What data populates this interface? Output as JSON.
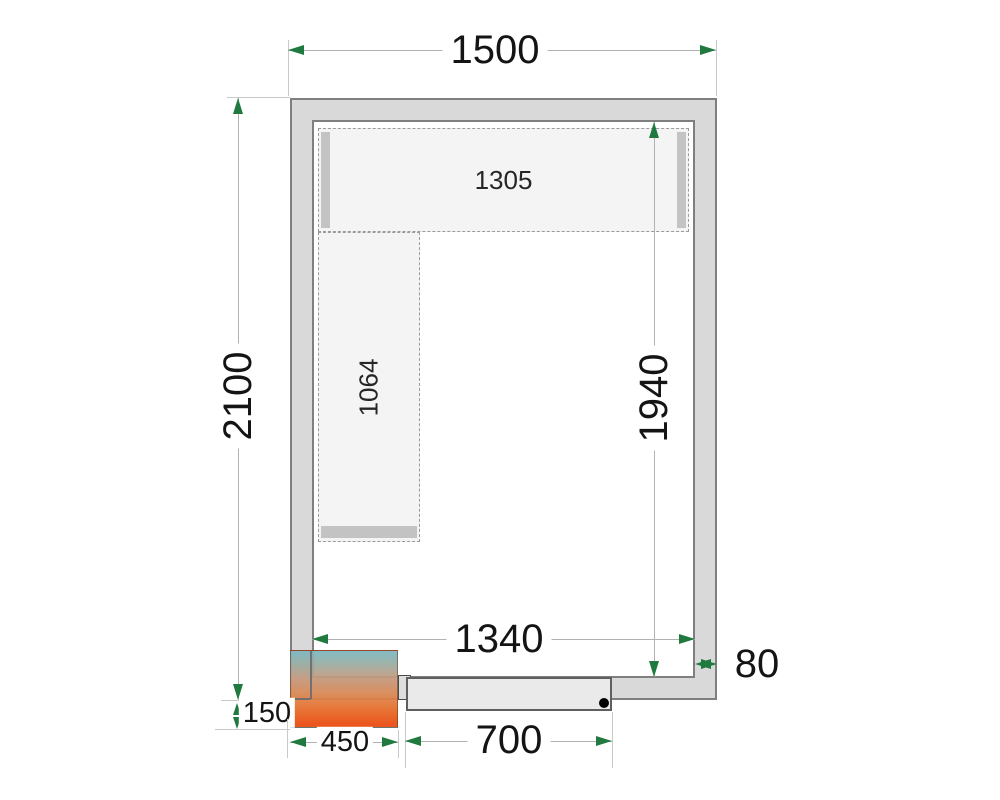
{
  "plan": {
    "title": "cold-room-floor-plan",
    "labels": {
      "outer_width": "1500",
      "outer_depth": "2100",
      "inner_depth": "1940",
      "inner_width": "1340",
      "wall_thickness": "80",
      "top_shelf_length": "1305",
      "side_shelf_length": "1064",
      "unit_width": "450",
      "unit_overhang": "150",
      "door_width": "700"
    },
    "colors": {
      "wall_fill": "#d9d9d9",
      "wall_outline": "#7f7f7f",
      "arrowhead_green": "#20793f",
      "dimension_line": "#b2b2b2",
      "extension_line": "#c9c9c9",
      "shelf_fill": "#f4f4f5",
      "shelf_support": "#c3c3c3",
      "door_fill": "#eaeaea",
      "unit_gradient_top": "#7ab7c3",
      "unit_gradient_bottom": "#ea4a0e",
      "hinge_dot": "#000000"
    }
  }
}
